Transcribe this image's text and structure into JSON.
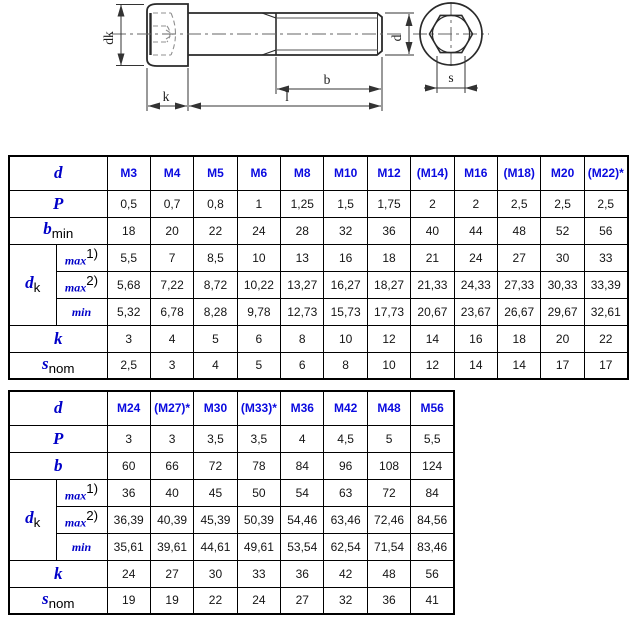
{
  "colors": {
    "label_blue": "#0000C8",
    "header_blue": "#0A0AE0",
    "drawing_line": "#2a2a2a"
  },
  "drawing": {
    "labels": {
      "head_diameter": "dk",
      "head_height": "k",
      "total_length": "l",
      "thread_length": "b",
      "diameter": "d",
      "socket_size": "s"
    }
  },
  "table1": {
    "corner_label": "d",
    "columns": [
      "M3",
      "M4",
      "M5",
      "M6",
      "M8",
      "M10",
      "M12",
      "(M14)",
      "M16",
      "(M18)",
      "M20",
      "(M22)*"
    ],
    "rows": [
      {
        "label": "P",
        "values": [
          "0,5",
          "0,7",
          "0,8",
          "1",
          "1,25",
          "1,5",
          "1,75",
          "2",
          "2",
          "2,5",
          "2,5",
          "2,5"
        ]
      },
      {
        "label": "b",
        "sub": "min",
        "values": [
          "18",
          "20",
          "22",
          "24",
          "28",
          "32",
          "36",
          "40",
          "44",
          "48",
          "52",
          "56"
        ]
      },
      {
        "label": "d",
        "sub": "k",
        "subrows": [
          {
            "label": "max",
            "sup": "1)",
            "values": [
              "5,5",
              "7",
              "8,5",
              "10",
              "13",
              "16",
              "18",
              "21",
              "24",
              "27",
              "30",
              "33"
            ]
          },
          {
            "label": "max",
            "sup": "2)",
            "values": [
              "5,68",
              "7,22",
              "8,72",
              "10,22",
              "13,27",
              "16,27",
              "18,27",
              "21,33",
              "24,33",
              "27,33",
              "30,33",
              "33,39"
            ]
          },
          {
            "label": "min",
            "values": [
              "5,32",
              "6,78",
              "8,28",
              "9,78",
              "12,73",
              "15,73",
              "17,73",
              "20,67",
              "23,67",
              "26,67",
              "29,67",
              "32,61"
            ]
          }
        ]
      },
      {
        "label": "k",
        "values": [
          "3",
          "4",
          "5",
          "6",
          "8",
          "10",
          "12",
          "14",
          "16",
          "18",
          "20",
          "22"
        ]
      },
      {
        "label": "s",
        "sub": "nom",
        "values": [
          "2,5",
          "3",
          "4",
          "5",
          "6",
          "8",
          "10",
          "12",
          "14",
          "14",
          "17",
          "17"
        ]
      }
    ]
  },
  "table2": {
    "corner_label": "d",
    "columns": [
      "M24",
      "(M27)*",
      "M30",
      "(M33)*",
      "M36",
      "M42",
      "M48",
      "M56"
    ],
    "rows": [
      {
        "label": "P",
        "values": [
          "3",
          "3",
          "3,5",
          "3,5",
          "4",
          "4,5",
          "5",
          "5,5"
        ]
      },
      {
        "label": "b",
        "values": [
          "60",
          "66",
          "72",
          "78",
          "84",
          "96",
          "108",
          "124"
        ]
      },
      {
        "label": "d",
        "sub": "k",
        "subrows": [
          {
            "label": "max",
            "sup": "1)",
            "values": [
              "36",
              "40",
              "45",
              "50",
              "54",
              "63",
              "72",
              "84"
            ]
          },
          {
            "label": "max",
            "sup": "2)",
            "values": [
              "36,39",
              "40,39",
              "45,39",
              "50,39",
              "54,46",
              "63,46",
              "72,46",
              "84,56"
            ]
          },
          {
            "label": "min",
            "values": [
              "35,61",
              "39,61",
              "44,61",
              "49,61",
              "53,54",
              "62,54",
              "71,54",
              "83,46"
            ]
          }
        ]
      },
      {
        "label": "k",
        "values": [
          "24",
          "27",
          "30",
          "33",
          "36",
          "42",
          "48",
          "56"
        ]
      },
      {
        "label": "s",
        "sub": "nom",
        "values": [
          "19",
          "19",
          "22",
          "24",
          "27",
          "32",
          "36",
          "41"
        ]
      }
    ]
  }
}
